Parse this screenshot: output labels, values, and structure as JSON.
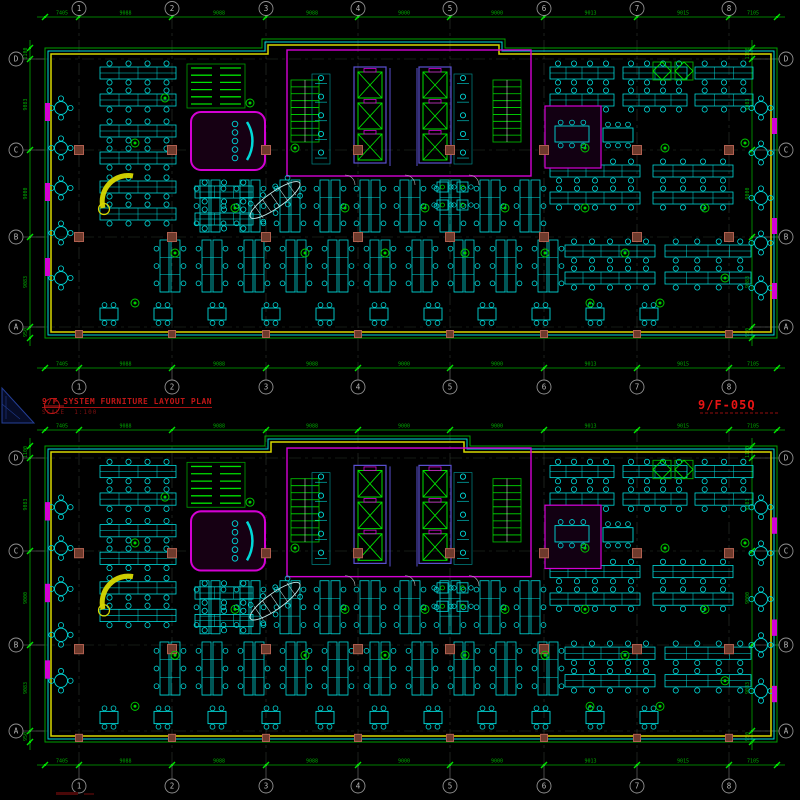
{
  "title_block": {
    "plan_title": "9/F SYSTEM FURNITURE LAYOUT PLAN",
    "scale_label": "SCALE",
    "scale_value": "1:100",
    "sheet_no": "9/F-05Q"
  },
  "grid": {
    "cols": [
      "1",
      "2",
      "3",
      "4",
      "5",
      "6",
      "7",
      "8"
    ],
    "rows": [
      "D",
      "C",
      "B",
      "A"
    ],
    "h_dims": [
      "7405",
      "9088",
      "9088",
      "9088",
      "9000",
      "9000",
      "9013",
      "9015",
      "7105"
    ],
    "v_dims": [
      "1100",
      "9083",
      "9000",
      "9083",
      "950"
    ]
  },
  "plans": [
    {
      "id": "upper-floor-plan"
    },
    {
      "id": "lower-floor-plan"
    }
  ],
  "colors": {
    "bg": "#000000",
    "dim_green": "#00a800",
    "bright_green": "#00e000",
    "cyan": "#00d8d8",
    "yellow": "#d8d800",
    "magenta": "#d400d4",
    "purple": "#5a4fd0",
    "red": "#c01616",
    "bright_red": "#e81414",
    "gray": "#9a9a9a",
    "white": "#cccccc",
    "column_fill": "#6e3a2c",
    "column_stroke": "#b06050",
    "dark_blue": "#2743a0"
  }
}
